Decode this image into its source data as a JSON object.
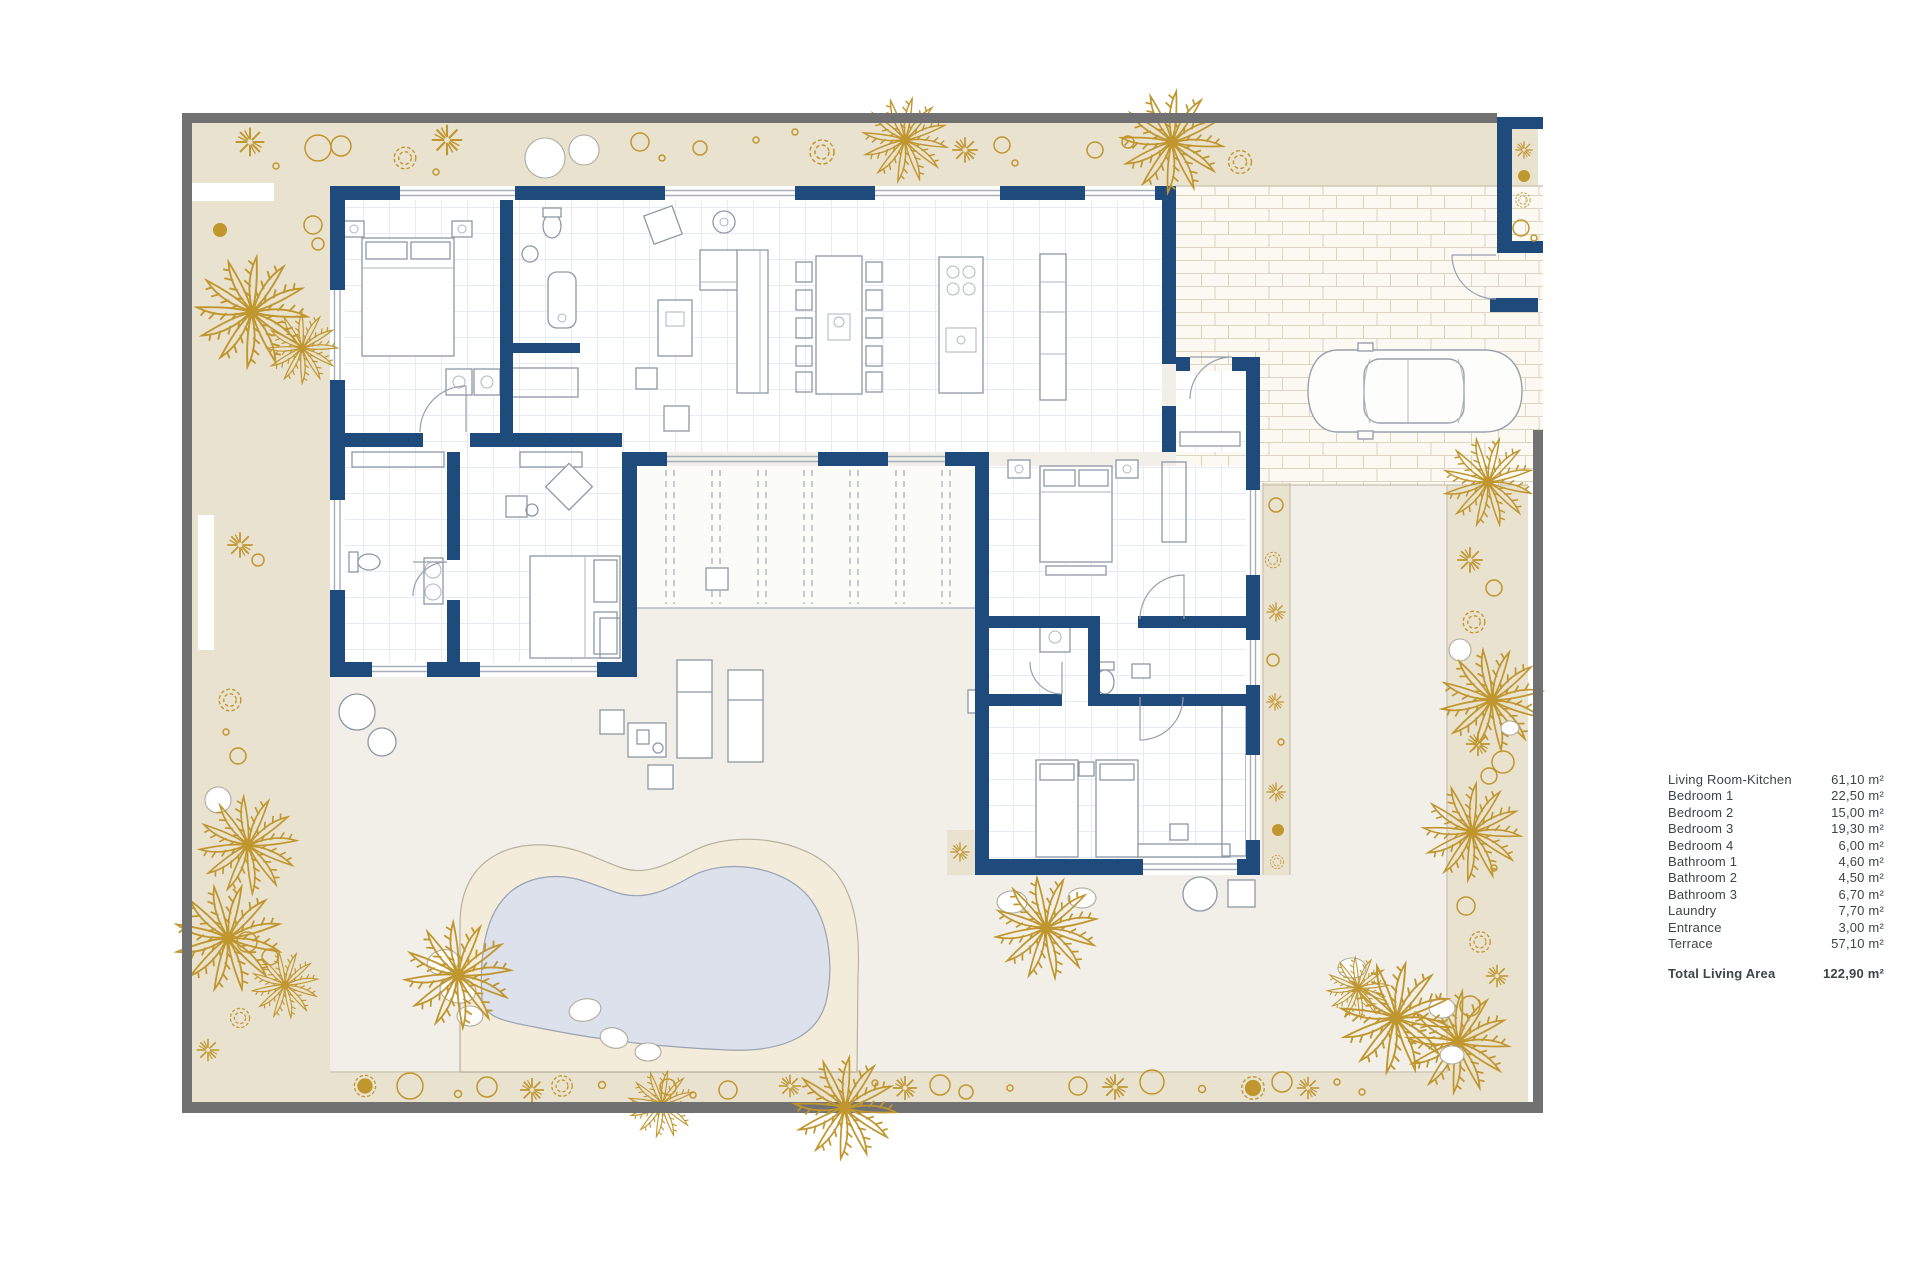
{
  "document": {
    "type": "architectural floor plan",
    "description": "Single-storey villa plan with garden, pool, terrace and driveway"
  },
  "legend": {
    "rows": [
      {
        "label": "Living Room-Kitchen",
        "value": "61,10 m²"
      },
      {
        "label": "Bedroom 1",
        "value": "22,50 m²"
      },
      {
        "label": "Bedroom 2",
        "value": "15,00 m²"
      },
      {
        "label": "Bedroom 3",
        "value": "19,30 m²"
      },
      {
        "label": "Bedroom 4",
        "value": "6,00 m²"
      },
      {
        "label": "Bathroom 1",
        "value": "4,60 m²"
      },
      {
        "label": "Bathroom 2",
        "value": "4,50 m²"
      },
      {
        "label": "Bathroom 3",
        "value": "6,70 m²"
      },
      {
        "label": "Laundry",
        "value": "7,70 m²"
      },
      {
        "label": "Entrance",
        "value": "3,00 m²"
      },
      {
        "label": "Terrace",
        "value": "57,10 m²"
      }
    ],
    "total": {
      "label": "Total Living Area",
      "value": "122,90 m²"
    }
  },
  "colors": {
    "navy": "#1f4a7c",
    "gold": "#c0962f",
    "beige": "#e9e2cf",
    "terrace": "#f1efe8",
    "sand": "#f3ecda",
    "water": "#dce1eb",
    "frame": "#717171",
    "legendtext": "#3d4546"
  }
}
